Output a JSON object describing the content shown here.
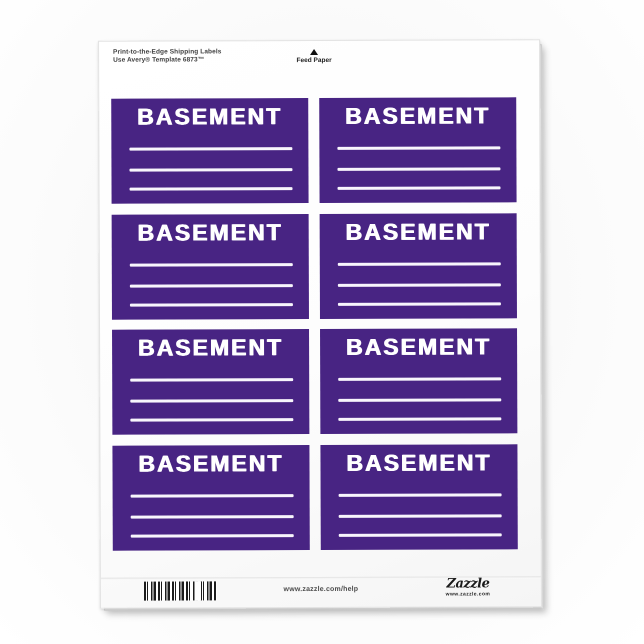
{
  "canvas": {
    "background_color": "#f8f8f8",
    "sheet_color": "#fdfdfd",
    "label_background_color": "#482483",
    "label_text_color": "#ffffff"
  },
  "sheet": {
    "header": {
      "title_line1": "Print-to-the-Edge Shipping Labels",
      "title_line2": "Use Avery® Template 6873™"
    },
    "feed_paper": {
      "icon": "triangle-up",
      "label": "Feed Paper"
    },
    "labels": [
      {
        "title": "BASEMENT"
      },
      {
        "title": "BASEMENT"
      },
      {
        "title": "BASEMENT"
      },
      {
        "title": "BASEMENT"
      },
      {
        "title": "BASEMENT"
      },
      {
        "title": "BASEMENT"
      },
      {
        "title": "BASEMENT"
      },
      {
        "title": "BASEMENT"
      }
    ],
    "footer": {
      "help_url": "www.zazzle.com/help",
      "logo_wordmark": "Zazzle",
      "logo_tagline": "www.zazzle.com"
    }
  }
}
